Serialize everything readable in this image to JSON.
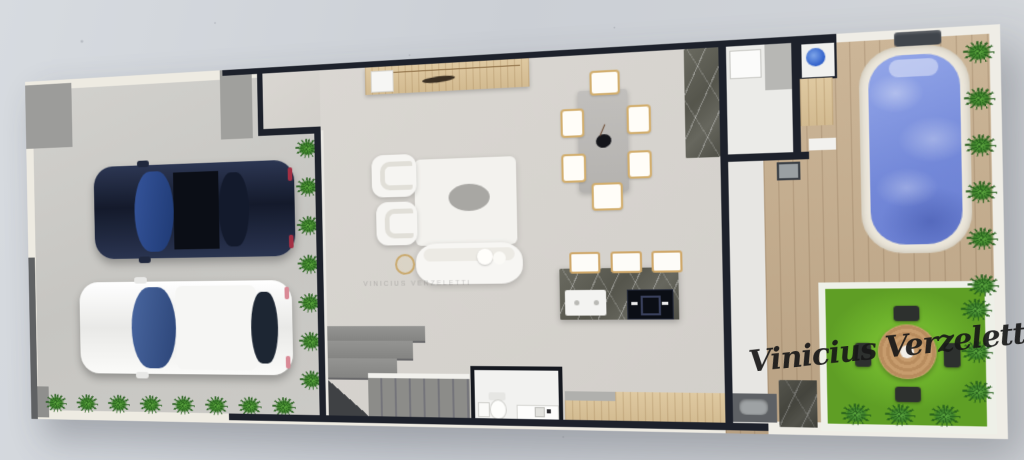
{
  "meta": {
    "type": "3D rendered floor plan, top view",
    "artist_signature": "Vinicius Verzeletti",
    "watermark": "VINICIUS VERZELETTI"
  },
  "areas": {
    "garage": {
      "vehicles": [
        {
          "name": "sedan-top-view",
          "color": "#1b2a4d"
        },
        {
          "name": "hatchback-top-view",
          "color": "#f2f2f0"
        }
      ],
      "hedge_plants": 15,
      "concrete_pads": 3
    },
    "living_room": {
      "furniture": [
        "armchair",
        "armchair",
        "area-rug",
        "oval-coffee-table",
        "curved-sofa",
        "gold-side-table",
        "console-sideboard"
      ]
    },
    "dining_room": {
      "table_seats": 6,
      "centerpiece": "dark-vase",
      "feature_wall": "dark-marble"
    },
    "kitchen": {
      "island": "dark-marble",
      "stools": 3,
      "appliances": [
        "double-sink",
        "black-cooktop"
      ],
      "base_cabinet": "light-wood"
    },
    "stairs": {
      "shape": "L-shaped",
      "finish": "gray-carpet",
      "treads": 7,
      "landings": 3
    },
    "powder_room": {
      "fixtures": [
        "toilet",
        "vanity-sink",
        "paper-cabinet"
      ]
    },
    "service_area": {
      "fixtures": [
        "wash-basin-unit",
        "round-blue-basin",
        "wood-counter",
        "utility-box",
        "laundry-sink",
        "marble-pillar"
      ]
    },
    "backyard": {
      "pool": {
        "water_color": "#7d90dd",
        "coping": "#ece7db",
        "deck": "wood-planks",
        "bench": "dark-slate"
      },
      "lawn": {
        "color": "#6cb02b",
        "round_table_seats": 4
      },
      "hedge_plants": 12
    }
  },
  "palette": {
    "backdrop": "#cdd1d6",
    "plan_border": "#eeebe2",
    "wall": "#1d212b",
    "garage_floor": "#c8c7c3",
    "interior_floor": "#d7d4cf",
    "deck_wood": "#c8b294",
    "pool_water": "#7d90dd",
    "grass": "#6cb02b",
    "marble": "#5a5a51",
    "cabinet_wood": "#d9c49c",
    "stair_carpet": "#8a8a87",
    "plant_green": "#3c7f2a"
  }
}
